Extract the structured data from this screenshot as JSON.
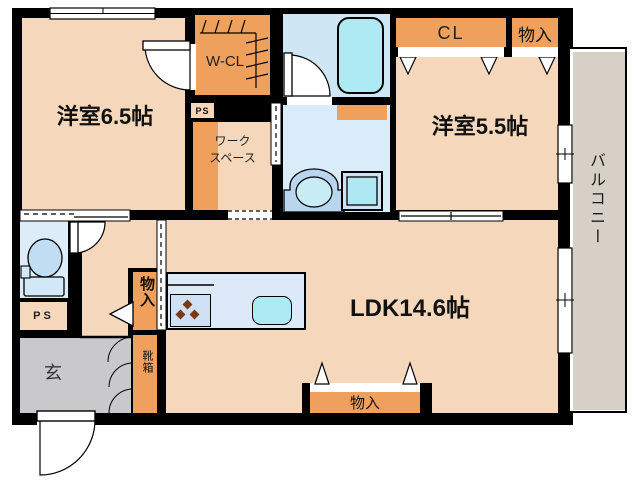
{
  "floorplan": {
    "rooms": {
      "bedroom1": {
        "label": "洋室6.5帖"
      },
      "bedroom2": {
        "label": "洋室5.5帖"
      },
      "ldk": {
        "label": "LDK14.6帖"
      },
      "balcony": {
        "label": "バルコニー"
      },
      "walk_in_closet": {
        "label": "W-CL"
      },
      "closet": {
        "label": "CL"
      },
      "storage_top": {
        "label": "物入"
      },
      "storage_ldk": {
        "label": "物入"
      },
      "storage_hall": {
        "label": "物入"
      },
      "shoe_box": {
        "label": "靴箱"
      },
      "workspace": {
        "line1": "ワーク",
        "line2": "スペース"
      },
      "entrance": {
        "label": "玄"
      },
      "pipe_space_upper": {
        "label": "PS"
      },
      "pipe_space_lower": {
        "label": "PS"
      }
    },
    "colors": {
      "wall": "#000000",
      "room_floor": "#f5d8bb",
      "storage_orange": "#efa05c",
      "wet_blue": "#d9ecf9",
      "bath_blue": "#cfe7f5",
      "fixture_cyan": "#aeeaf4",
      "kitchen_counter": "#dbe9f8",
      "stove_panel": "#cfe0f4",
      "entrance_gray": "#c9c9cc",
      "balcony_gray": "#d7d0c6",
      "burner_brown": "#7a3a12"
    }
  }
}
